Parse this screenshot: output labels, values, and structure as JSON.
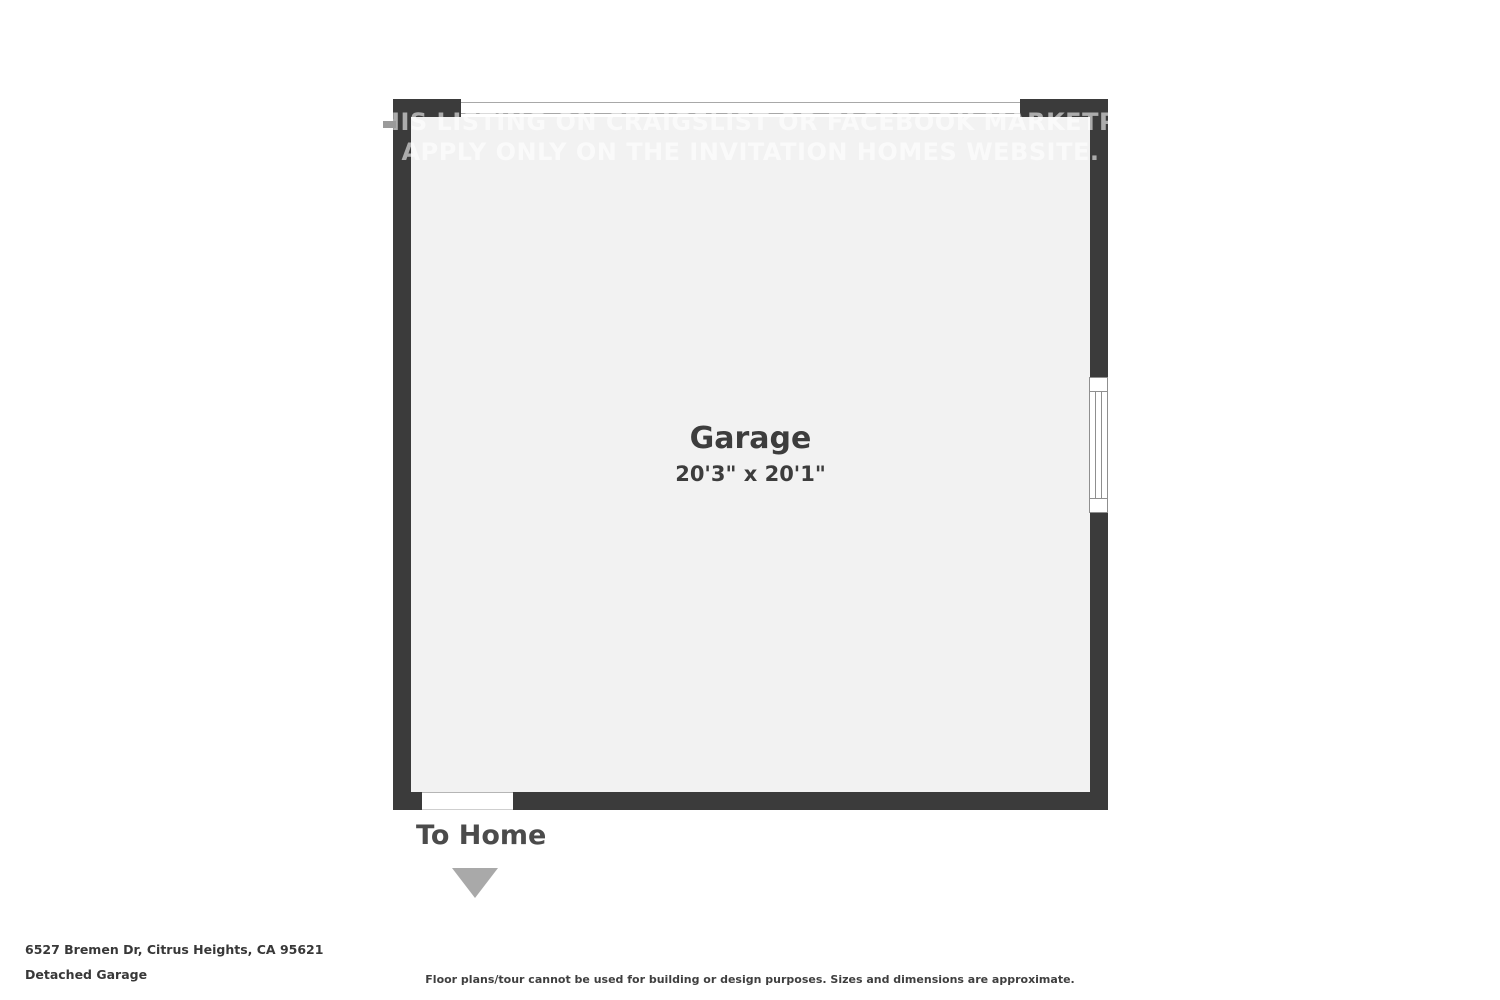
{
  "colors": {
    "wall": "#3b3b3b",
    "floor": "#f2f2f2",
    "text_dark": "#3d3d3d",
    "arrow_gray": "#a9a9a9",
    "background": "#ffffff"
  },
  "floor_plan": {
    "watermark_line1": "THIS LISTING ON CRAIGSLIST OR FACEBOOK MARKETPLACE",
    "watermark_line2": "APPLY ONLY ON THE INVITATION HOMES WEBSITE.",
    "room_name": "Garage",
    "room_dimensions": "20'3\" x 20'1\"",
    "exit_label": "To Home"
  },
  "footer": {
    "address": "6527 Bremen Dr, Citrus Heights, CA 95621",
    "plan_title": "Detached Garage",
    "disclaimer": "Floor plans/tour cannot be used for building or design purposes. Sizes and dimensions are approximate."
  }
}
